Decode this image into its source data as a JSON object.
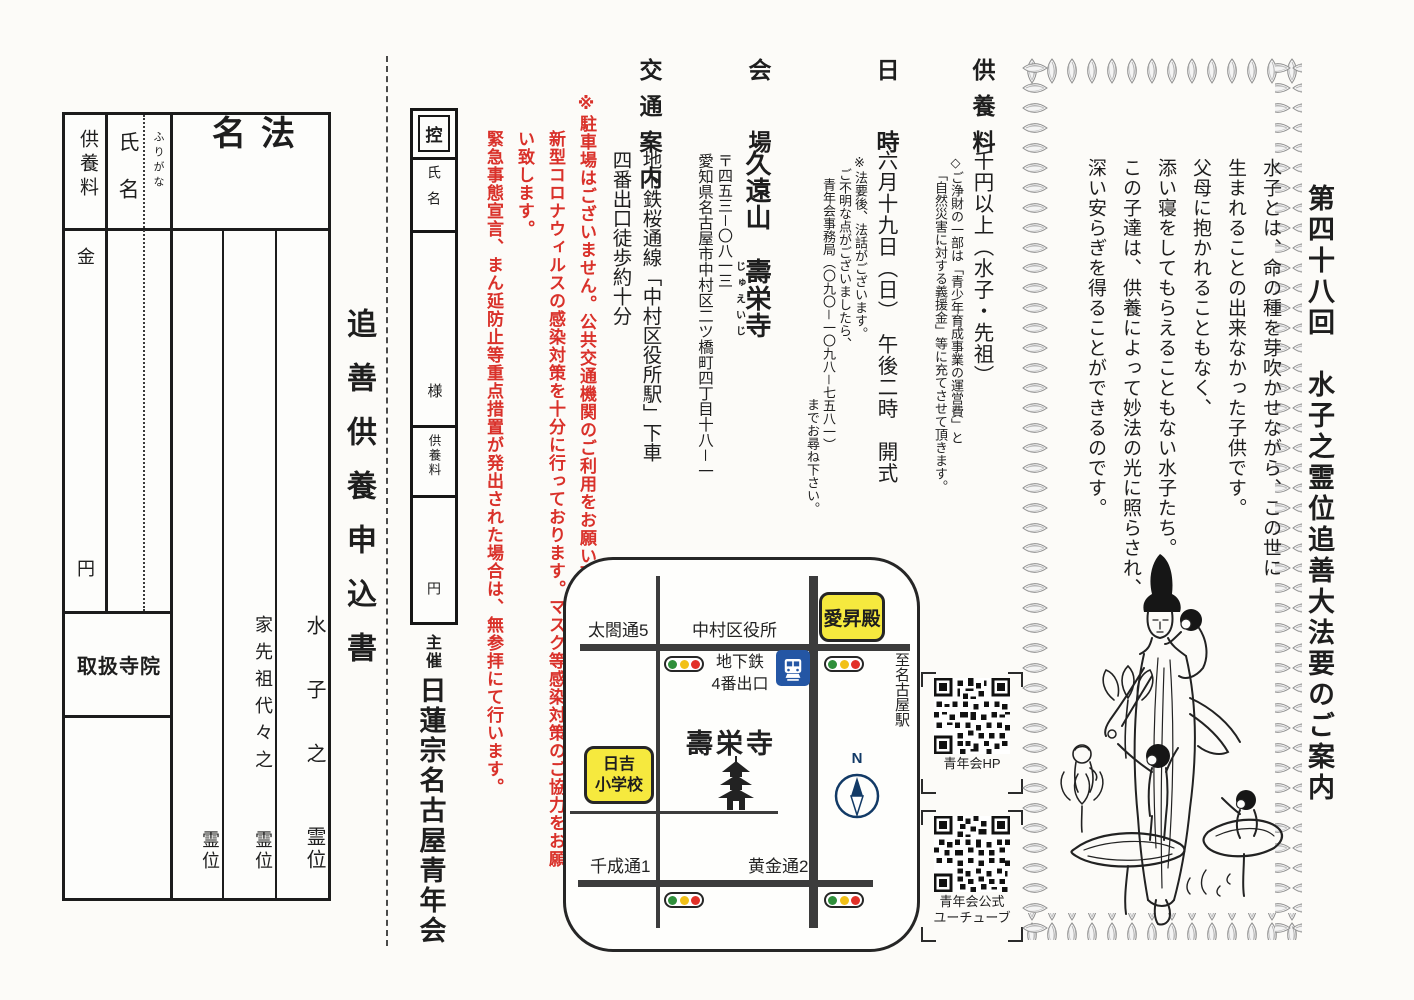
{
  "form": {
    "title": "追善供養申込書",
    "header_fee": "供養料",
    "header_name": "氏名",
    "header_furigana": "ふりがな",
    "header_homyo": "法名",
    "kin": "金",
    "yen": "円",
    "temple_box": "取扱寺院",
    "homyo1_top": "水子之",
    "homyo1_bottom": "霊位",
    "homyo2_top": "家先祖代々之",
    "homyo2_bottom": "霊位",
    "homyo3_bottom": "霊位"
  },
  "stub": {
    "label": "控",
    "name": "氏名",
    "sama": "様",
    "fee": "供養料",
    "yen": "円",
    "sponsor_label": "主催",
    "sponsor": "日蓮宗名古屋青年会"
  },
  "notice": {
    "col1": "※駐車場はございません。公共交通機関のご利用をお願い致します。",
    "col2": "新型コロナウィルスの感染対策を十分に行っております。マスク等感染対策のご協力をお願い致します。",
    "col3": "緊急事態宣言、まん延防止等重点措置が発出された場合は、無参拝にて行います。"
  },
  "info": {
    "fee": {
      "header": "供養料",
      "body": "千円以上（水子・先祖）",
      "note1": "◇ご浄財の一部は「青少年育成事業の運営費」と",
      "note2": "「自然災害に対する義援金」等に充てさせて頂きます。"
    },
    "datetime": {
      "header": "日　時",
      "body": "六月十九日（日）　午後二時　開式",
      "note1": "※法要後、法話がございます。",
      "note2": "ご不明な点がございましたら、",
      "note3": "青年会事務局（〇九〇－一〇九八－七五八一）",
      "note4": "までお尋ね下さい。"
    },
    "venue": {
      "header": "会　場",
      "body_prefix": "久遠山　",
      "temple": "壽栄寺",
      "ruby": "じゅえいじ",
      "postal": "〒四五三－〇八一三",
      "address": "愛知県名古屋市中村区二ツ橋町四丁目十八－一"
    },
    "access": {
      "header": "交通案内",
      "line1": "地下鉄桜通線「中村区役所駅」下車",
      "line2": "四番出口徒歩約十分"
    }
  },
  "map": {
    "taiko": "太閤通5",
    "ward_office": "中村区役所",
    "aishoden": "愛昇殿",
    "to_nagoya": "至名古屋駅",
    "subway1": "地下鉄",
    "subway2": "4番出口",
    "temple": "壽栄寺",
    "school1": "日吉",
    "school2": "小学校",
    "compass": "N",
    "sennari": "千成通1",
    "kogane": "黄金通2"
  },
  "qr": {
    "hp": "青年会HP",
    "yt1": "青年会公式",
    "yt2": "ユーチューブ"
  },
  "leaflet": {
    "title": "第四十八回　水子之霊位追善大法要のご案内",
    "intro1": "水子とは、命の種を芽吹かせながら、この世に",
    "intro2": "生まれることの出来なかった子供です。",
    "intro3": "父母に抱かれることもなく、",
    "intro4": "添い寝をしてもらえることもない水子たち。",
    "intro5": "この子達は、供養によって妙法の光に照らされ、",
    "intro6": "深い安らぎを得ることができるのです。"
  },
  "colors": {
    "red": "#d9312a",
    "yellow": "#f6e93e",
    "ink": "#1e1e1e"
  }
}
